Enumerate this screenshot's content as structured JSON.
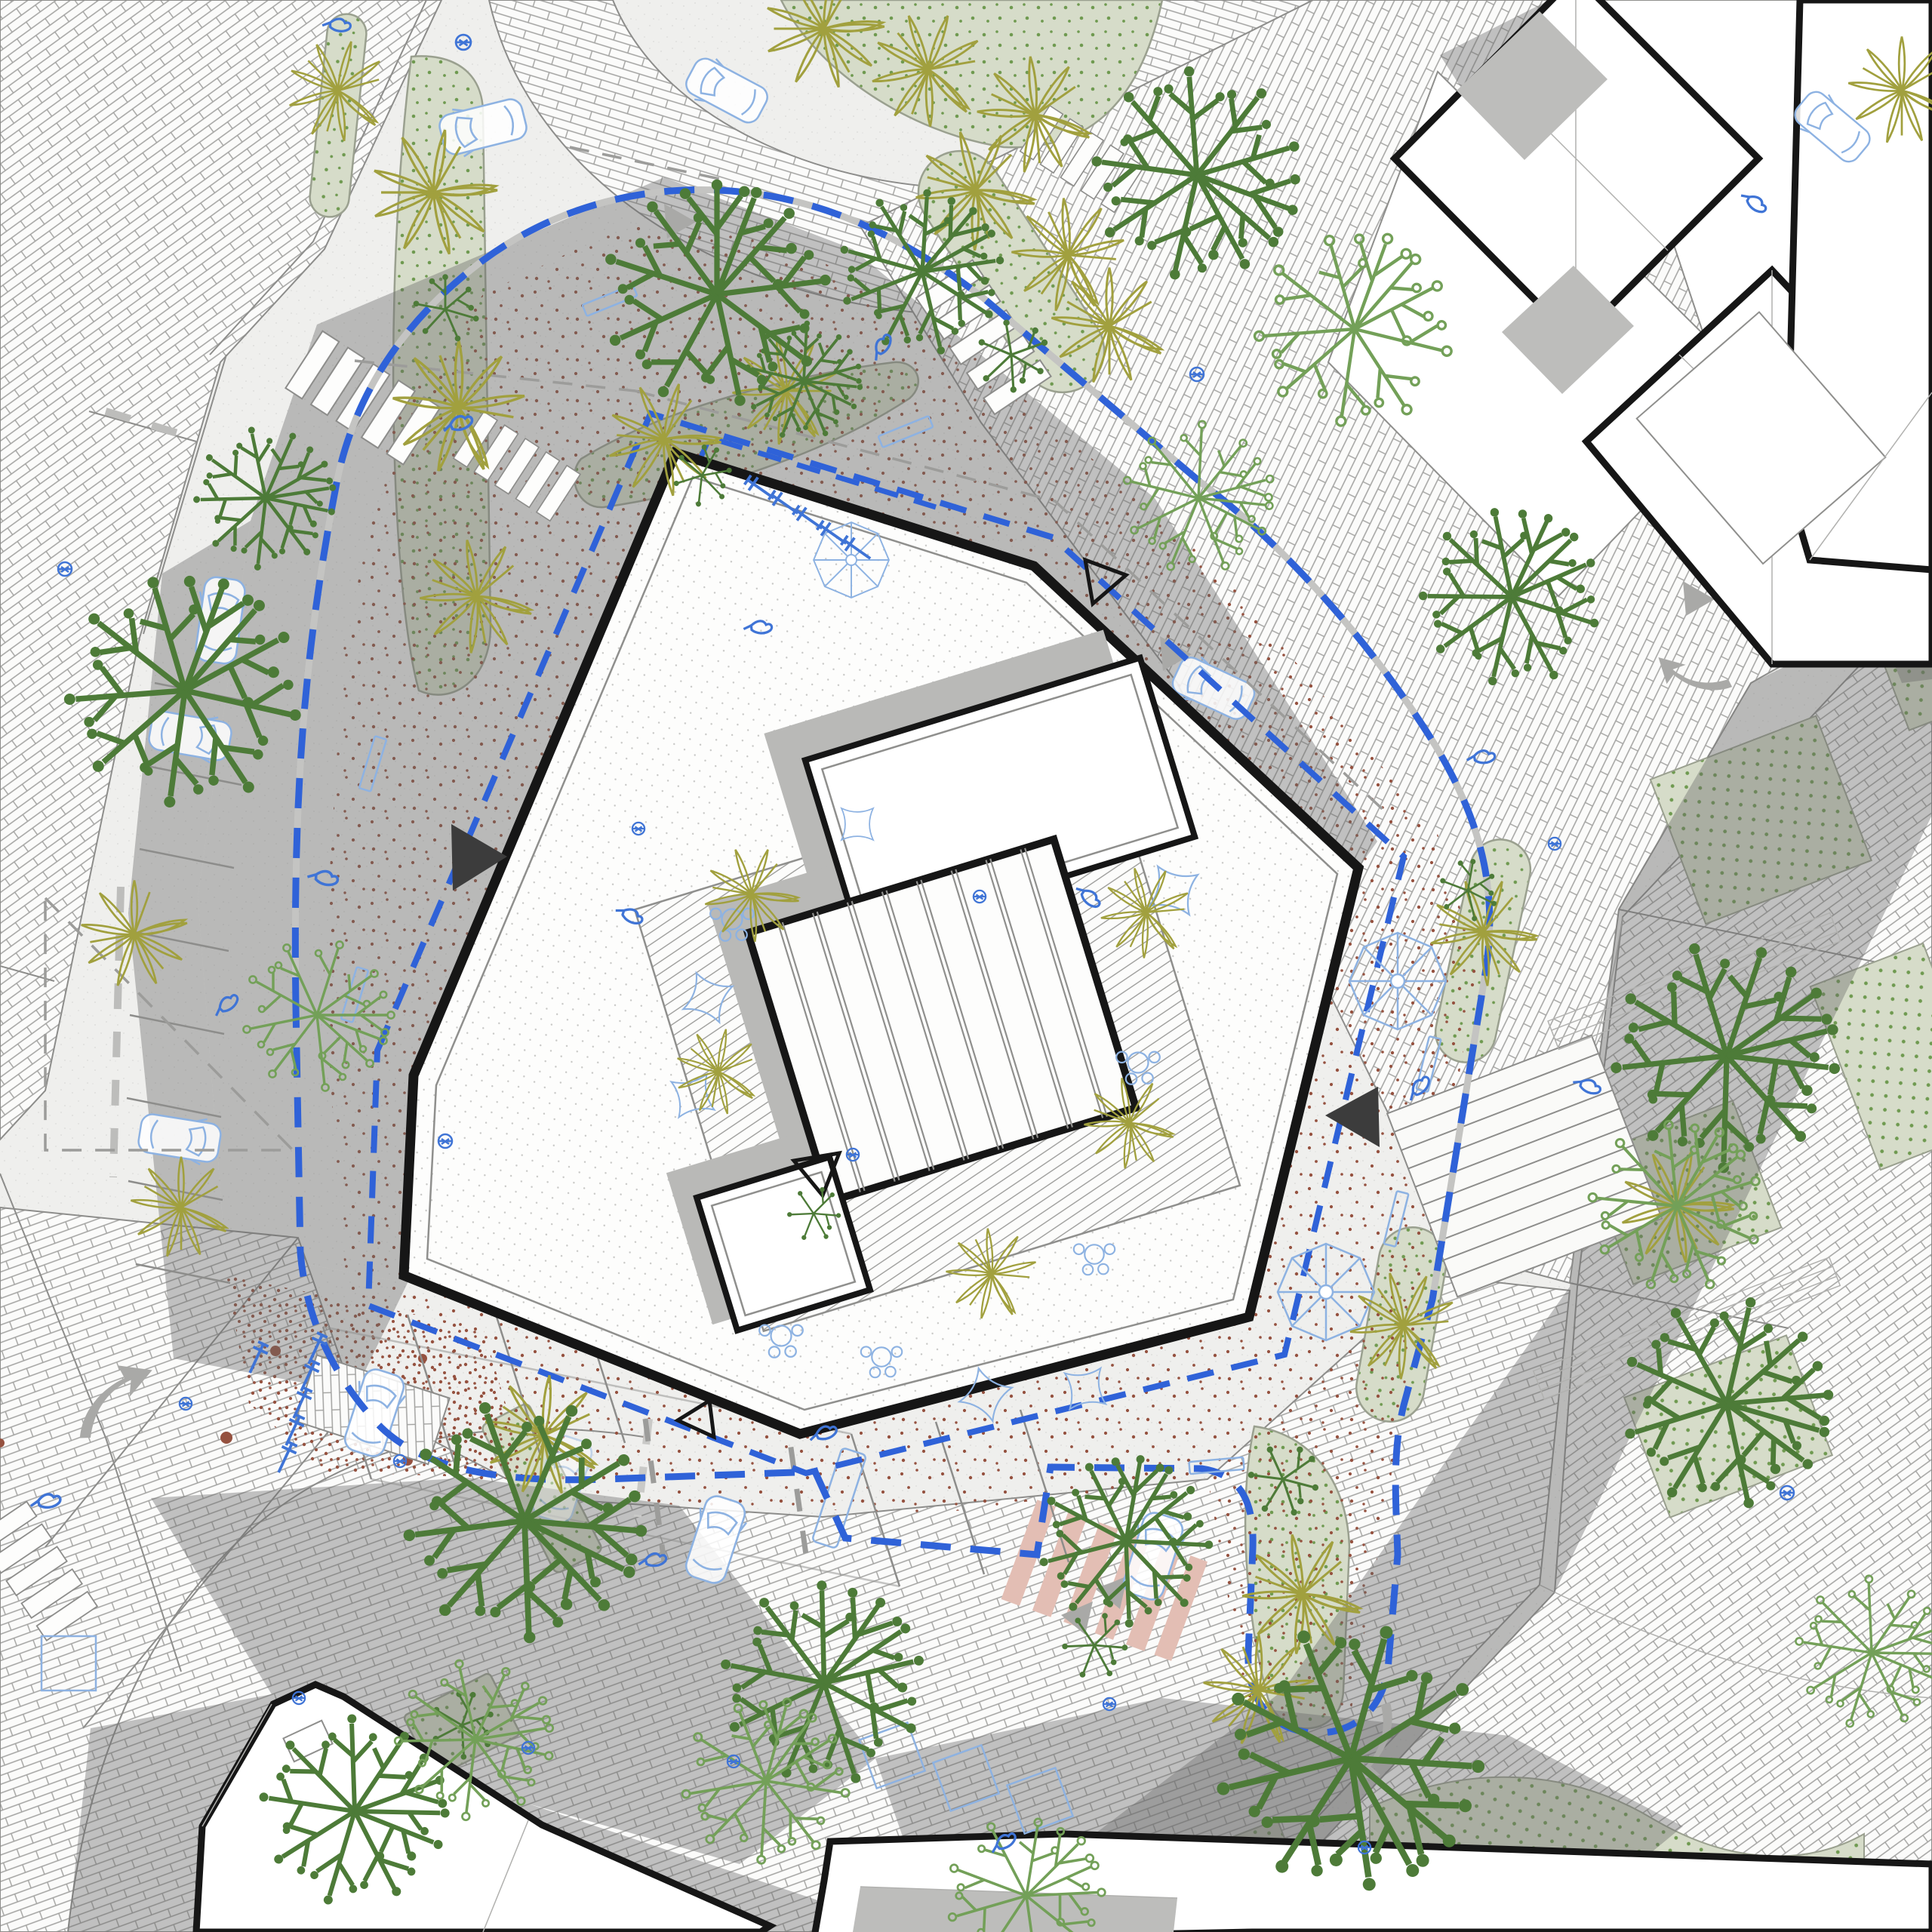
{
  "document": {
    "kind": "architectural-site-plan",
    "view": "roof-plan-with-landscape-context",
    "visible_text": "none"
  },
  "palette": {
    "paper": "#f3f3f1",
    "road": "#efefed",
    "brickline": "#a2a2a0",
    "brickfill": "#fbfbfa",
    "edge": "#8d8d8b",
    "shadow": "rgba(106,106,104,0.40)",
    "ink": "#161616",
    "roofdot": "#c7c7c5",
    "stipple": "#95513f",
    "sage": "#d6dcc9",
    "sagedot": "#6f9a50",
    "leafdark": "#4d7b38",
    "leafmid": "#73a058",
    "olive": "#a1a03e",
    "blue": "#2f62d8",
    "bluelight": "#8db2e2",
    "blueicon": "#3f74d6",
    "pink": "#e3beb4",
    "grayarrow": "#a9a9a7",
    "graydash": "#9c9c9a"
  },
  "symbols": [
    {
      "name": "site-boundary-dashed-line",
      "color_key": "blue",
      "style": "bold dashed loop around block"
    },
    {
      "name": "building-offset-dashed-line",
      "color_key": "blue",
      "style": "dashed line hugging facade"
    },
    {
      "name": "parcel-dashed-line",
      "color_key": "graydash",
      "style": "thin gray dashes"
    },
    {
      "name": "entrance-triangle-filled",
      "color_key": "ink",
      "count": 2
    },
    {
      "name": "entrance-triangle-hollow",
      "color_key": "ink",
      "count": 3
    },
    {
      "name": "tree-dandelion-solid-dots",
      "color_key": "leafdark",
      "count": 14
    },
    {
      "name": "tree-open-circle",
      "color_key": "leafmid",
      "count": 8
    },
    {
      "name": "palm-starburst",
      "color_key": "olive",
      "count": 26
    },
    {
      "name": "parasol-umbrella",
      "color_key": "bluelight",
      "count": 3
    },
    {
      "name": "cafe-table-set",
      "color_key": "bluelight",
      "count": 5
    },
    {
      "name": "shade-sail",
      "color_key": "bluelight",
      "count": 6
    },
    {
      "name": "bench",
      "color_key": "bluelight",
      "count": 7
    },
    {
      "name": "bike-rack",
      "color_key": "blueicon",
      "count": 11
    },
    {
      "name": "person-icon",
      "color_key": "blueicon",
      "count": 18
    },
    {
      "name": "car",
      "color_key": "bluelight",
      "count": 9
    },
    {
      "name": "crosswalk-white",
      "count": 4
    },
    {
      "name": "crosswalk-pink",
      "color_key": "pink",
      "count": 1
    },
    {
      "name": "stairs",
      "treads": 11
    },
    {
      "name": "direction-arrow-gray",
      "color_key": "grayarrow",
      "count": 5
    }
  ],
  "areas": [
    {
      "name": "central-building-roof",
      "fill": "white with fine dot grid",
      "outline": "thick black"
    },
    {
      "name": "roof-deck",
      "fill": "wood plank hatch"
    },
    {
      "name": "skylight",
      "fill": "white with glazing bars",
      "outline": "thick black"
    },
    {
      "name": "terrace-ring",
      "fill": "red-brown stipple gravel"
    },
    {
      "name": "playground",
      "fill": "dense red-brown stipple"
    },
    {
      "name": "planting-beds",
      "fill": "sage green with leaf dots"
    },
    {
      "name": "lawn-panels",
      "fill": "sage green with regular dot grid"
    },
    {
      "name": "brick-paving",
      "fill": "running-bond brick hatch"
    },
    {
      "name": "asphalt-roads",
      "fill": "light speckle"
    },
    {
      "name": "context-buildings",
      "fill": "white, thick black outline"
    },
    {
      "name": "cast-shadows",
      "fill": "translucent gray, light from south-east"
    }
  ]
}
